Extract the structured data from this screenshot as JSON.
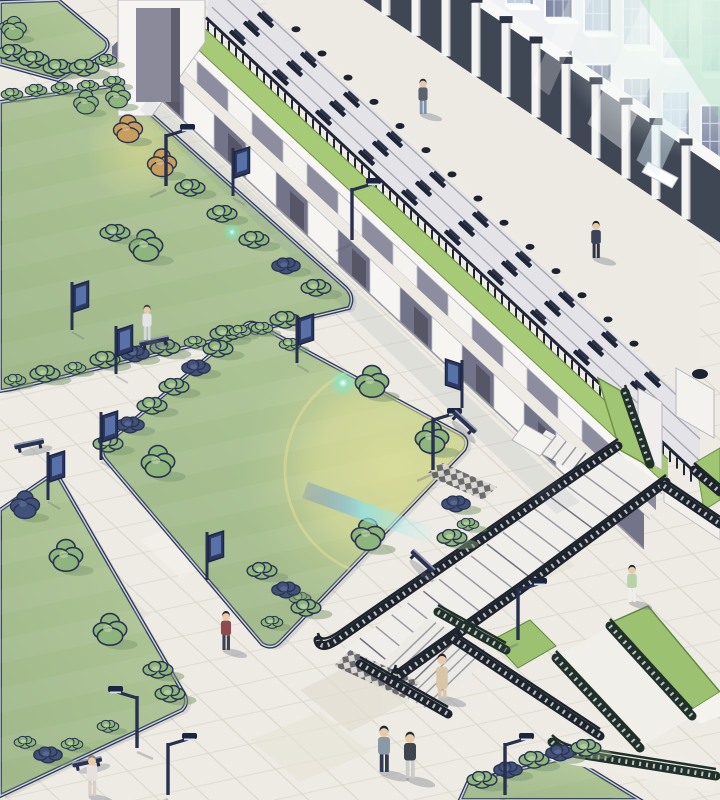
{
  "scene": {
    "description": "Isometric architectural illustration of a campus plaza: lawns with shrubs, paved walkways with navy edge rails, lamp and banner poles, a long two-tier arcade with a green roof strip, terraced outdoor seating rows with black benches, a tall glass-front building with sun flares, and a sunken stair/ramp court at lower right with black railings and green berms.",
    "palette": {
      "paving": "#edebe3",
      "paving_line_a": "#d8d4c9",
      "paving_line_b": "#dcd8cd",
      "lawn": "#b2c898",
      "lawn_shade": "#7d9a70",
      "edge_rail": "#2c3854",
      "edge_rail_light": "#cdd4e4",
      "arcade_white": "#f6f5f2",
      "arcade_panel_upper": "#8d8d9f",
      "arcade_panel_lower": "#73738a",
      "roof_grass": "#a7ca77",
      "roof_grass_edge": "#6e9148",
      "seat_step": "#e4e4e8",
      "seat_bench": "#1e2536",
      "facade_frame": "#f0f1f5",
      "glass_variants": [
        "#8e96b2",
        "#a9b4cc",
        "#c2d0e2",
        "#7d84a2",
        "#b8c8da"
      ],
      "portico_dark": "#3f4654",
      "railing_black": "#1d242e",
      "railing_green": "#20302a",
      "flare_yellow": "#e9e49a",
      "flare_cyan": "#8fe0e8",
      "flare_teal": "#7fe8c8",
      "corner_glow_green": "#8fd6a8",
      "bush_green": "#8fb57e",
      "bush_dark_navy": "#41517a",
      "bush_orange": "#c79e5e",
      "tree_outline": "#2a3450",
      "shadow": "#5f6678"
    },
    "arcade": {
      "lower_bays": 8,
      "upper_bays": 9,
      "roof_strip": "grass",
      "left_end_pavilion": true,
      "right_end_block": true
    },
    "seating_terrace": {
      "rows": 3,
      "bench_rows_c": [
        -180,
        -202,
        -224
      ],
      "bench_start_x": 236,
      "bench_end_x": 664,
      "bench_spacing": 43,
      "railing_baluster_spacing": 7
    },
    "knobs": {
      "start_x": 296,
      "end_x": 652,
      "spacing": 26
    },
    "colonnade": {
      "start_x": 356,
      "count": 12,
      "spacing_x": 30
    },
    "facade": {
      "mullion_start_x": 428,
      "mullion_spacing": 39,
      "window_w": 27,
      "window_h": 72,
      "row_intercepts": [
        -245,
        -140,
        -35
      ],
      "row_slope": 0.35
    },
    "flares": {
      "big_yellow": {
        "x": 393,
        "y": 470,
        "r": 108
      },
      "small_yellow": {
        "x": 140,
        "y": 150,
        "r": 55
      },
      "teal_spark_1": {
        "x": 343,
        "y": 383
      },
      "teal_spark_2": {
        "x": 232,
        "y": 232
      },
      "stair_cyan_streak": {
        "x1": 308,
        "y1": 482,
        "x2": 436,
        "y2": 528
      },
      "corner_glow": {
        "x": 695,
        "y": 8,
        "r": 150
      }
    },
    "people": [
      {
        "x": 423,
        "y": 114,
        "s": 0.95,
        "top": "#5a6270",
        "bottom": "#7d92ac",
        "hair": "#22262e",
        "note": "upper terrace walker"
      },
      {
        "x": 596,
        "y": 258,
        "s": 1.0,
        "top": "#3c4458",
        "bottom": "#2e3442",
        "hair": "#1a1a22",
        "note": "terrace walker right"
      },
      {
        "x": 147,
        "y": 340,
        "s": 0.95,
        "top": "#e3e4e6",
        "bottom": "#d7d8da",
        "hair": "#3a3a42",
        "note": "white outfit on path"
      },
      {
        "x": 632,
        "y": 602,
        "s": 1.0,
        "top": "#b7d2a8",
        "bottom": "#eef0ee",
        "hair": "#26262e",
        "note": "green tee near stairs"
      },
      {
        "x": 442,
        "y": 698,
        "s": 1.2,
        "coat": true,
        "top": "#d9c6a8",
        "bottom": "#d9c6a8",
        "hair": "#2b2430",
        "note": "beige long coat"
      },
      {
        "x": 384,
        "y": 772,
        "s": 1.25,
        "top": "#8a98a8",
        "bottom": "#323a50",
        "hair": "#20242c",
        "note": "gray jacket man"
      },
      {
        "x": 410,
        "y": 778,
        "s": 1.25,
        "top": "#3f444e",
        "bottom": "#c9ccc8",
        "hair": "#262a30",
        "note": "dark tee man"
      },
      {
        "x": 226,
        "y": 650,
        "s": 1.05,
        "top": "#8e4a50",
        "bottom": "#3c4254",
        "hair": "#2e2228",
        "note": "red jacket on path"
      },
      {
        "x": 92,
        "y": 796,
        "s": 1.1,
        "top": "#e8e0dc",
        "bottom": "#d8d0c8",
        "hair": "#8a8278",
        "note": "bottom left partial"
      }
    ],
    "lamps": [
      {
        "x": 166,
        "y": 186,
        "dir": -1
      },
      {
        "x": 352,
        "y": 240,
        "dir": -1
      },
      {
        "x": 433,
        "y": 470,
        "dir": -1
      },
      {
        "x": 518,
        "y": 640,
        "dir": -1
      },
      {
        "x": 137,
        "y": 748,
        "dir": 1
      },
      {
        "x": 168,
        "y": 795,
        "dir": -1
      },
      {
        "x": 505,
        "y": 795,
        "dir": -1
      }
    ],
    "banners": [
      {
        "x": 233,
        "y": 196,
        "dir": 1
      },
      {
        "x": 72,
        "y": 330,
        "dir": 1
      },
      {
        "x": 116,
        "y": 374,
        "dir": 1
      },
      {
        "x": 48,
        "y": 500,
        "dir": 1
      },
      {
        "x": 101,
        "y": 460,
        "dir": 1
      },
      {
        "x": 207,
        "y": 580,
        "dir": 1
      },
      {
        "x": 462,
        "y": 408,
        "dir": -1
      },
      {
        "x": 297,
        "y": 363,
        "dir": 1
      }
    ],
    "benches_ground": [
      {
        "x": 155,
        "y": 345,
        "a": -12
      },
      {
        "x": 30,
        "y": 448,
        "a": -12
      },
      {
        "x": 462,
        "y": 425,
        "a": 43
      },
      {
        "x": 420,
        "y": 564,
        "a": 43
      },
      {
        "x": 88,
        "y": 766,
        "a": -12
      }
    ],
    "vegetation": [
      {
        "t": "bushM",
        "x": 12,
        "y": 55
      },
      {
        "t": "bushM",
        "x": 34,
        "y": 62
      },
      {
        "t": "bushM",
        "x": 58,
        "y": 70
      },
      {
        "t": "bushM",
        "x": 84,
        "y": 70
      },
      {
        "t": "bushS",
        "x": 106,
        "y": 62
      },
      {
        "t": "bushS",
        "x": 10,
        "y": 28
      },
      {
        "t": "bushS",
        "x": 12,
        "y": 96
      },
      {
        "t": "bushS",
        "x": 36,
        "y": 92
      },
      {
        "t": "bushS",
        "x": 62,
        "y": 90
      },
      {
        "t": "bushS",
        "x": 88,
        "y": 88
      },
      {
        "t": "bushS",
        "x": 114,
        "y": 84
      },
      {
        "t": "treeS",
        "x": 86,
        "y": 110
      },
      {
        "t": "treeS",
        "x": 118,
        "y": 104
      },
      {
        "t": "treeO",
        "x": 128,
        "y": 138
      },
      {
        "t": "treeO",
        "x": 162,
        "y": 172
      },
      {
        "t": "bushM",
        "x": 190,
        "y": 190
      },
      {
        "t": "bushM",
        "x": 222,
        "y": 216
      },
      {
        "t": "bushM",
        "x": 254,
        "y": 242
      },
      {
        "t": "bushD",
        "x": 286,
        "y": 268
      },
      {
        "t": "bushM",
        "x": 316,
        "y": 290
      },
      {
        "t": "tree",
        "x": 146,
        "y": 256
      },
      {
        "t": "bushM",
        "x": 115,
        "y": 235
      },
      {
        "t": "bushS",
        "x": 15,
        "y": 382
      },
      {
        "t": "bushM",
        "x": 45,
        "y": 376
      },
      {
        "t": "bushS",
        "x": 75,
        "y": 370
      },
      {
        "t": "bushM",
        "x": 105,
        "y": 362
      },
      {
        "t": "bushD",
        "x": 135,
        "y": 356
      },
      {
        "t": "bushM",
        "x": 165,
        "y": 350
      },
      {
        "t": "bushS",
        "x": 195,
        "y": 344
      },
      {
        "t": "bushM",
        "x": 225,
        "y": 336
      },
      {
        "t": "bushS",
        "x": 255,
        "y": 330
      },
      {
        "t": "bushM",
        "x": 285,
        "y": 322
      },
      {
        "t": "bushM",
        "x": 108,
        "y": 446
      },
      {
        "t": "bushD",
        "x": 130,
        "y": 427
      },
      {
        "t": "bushM",
        "x": 152,
        "y": 408
      },
      {
        "t": "bushM",
        "x": 174,
        "y": 389
      },
      {
        "t": "bushD",
        "x": 196,
        "y": 370
      },
      {
        "t": "bushM",
        "x": 218,
        "y": 351
      },
      {
        "t": "bushS",
        "x": 240,
        "y": 333
      },
      {
        "t": "bushS",
        "x": 262,
        "y": 330
      },
      {
        "t": "bushS",
        "x": 290,
        "y": 346
      },
      {
        "t": "tree",
        "x": 372,
        "y": 392
      },
      {
        "t": "tree",
        "x": 432,
        "y": 448
      },
      {
        "t": "tree",
        "x": 158,
        "y": 472
      },
      {
        "t": "tree",
        "x": 368,
        "y": 545
      },
      {
        "t": "bushM",
        "x": 452,
        "y": 540
      },
      {
        "t": "bushS",
        "x": 468,
        "y": 526
      },
      {
        "t": "bushD",
        "x": 456,
        "y": 506
      },
      {
        "t": "bushS",
        "x": 300,
        "y": 600
      },
      {
        "t": "bushS",
        "x": 272,
        "y": 624
      },
      {
        "t": "bushM",
        "x": 262,
        "y": 573
      },
      {
        "t": "bushD",
        "x": 286,
        "y": 592
      },
      {
        "t": "bushM",
        "x": 306,
        "y": 610
      },
      {
        "t": "treeD",
        "x": 25,
        "y": 514
      },
      {
        "t": "tree",
        "x": 66,
        "y": 566
      },
      {
        "t": "tree",
        "x": 110,
        "y": 640
      },
      {
        "t": "bushM",
        "x": 158,
        "y": 672
      },
      {
        "t": "bushM",
        "x": 170,
        "y": 696
      },
      {
        "t": "bushS",
        "x": 25,
        "y": 744
      },
      {
        "t": "bushD",
        "x": 48,
        "y": 757
      },
      {
        "t": "bushS",
        "x": 72,
        "y": 746
      },
      {
        "t": "bushS",
        "x": 108,
        "y": 728
      },
      {
        "t": "bushM",
        "x": 482,
        "y": 782
      },
      {
        "t": "bushD",
        "x": 508,
        "y": 772
      },
      {
        "t": "bushM",
        "x": 534,
        "y": 762
      },
      {
        "t": "bushD",
        "x": 560,
        "y": 755
      },
      {
        "t": "bushM",
        "x": 586,
        "y": 750
      },
      {
        "t": "treeS",
        "x": 14,
        "y": 36
      }
    ]
  }
}
